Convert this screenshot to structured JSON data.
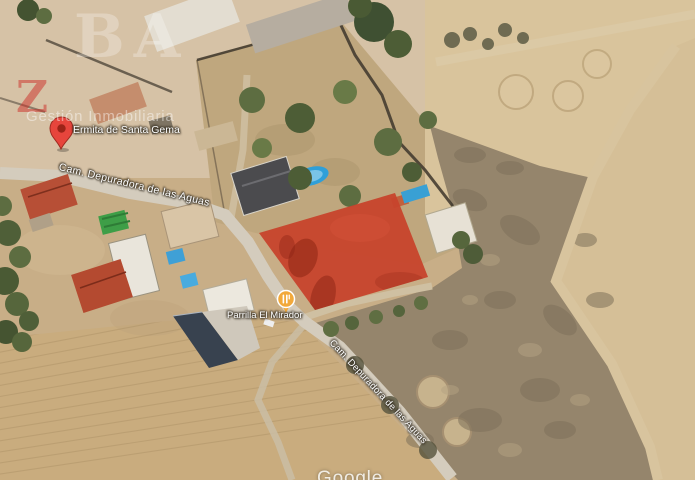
{
  "map": {
    "attribution": "Google",
    "marker": {
      "label": "Ermita de Santa Gema",
      "icon": "red-map-pin"
    },
    "poi": {
      "label": "Parrilla El Mirador",
      "icon": "restaurant-icon"
    },
    "road_labels": [
      {
        "id": "upper",
        "text": "Cam. Depuradora de las Aguas"
      },
      {
        "id": "lower",
        "text": "Cam. Depuradora de las Aguas"
      }
    ],
    "highlighted_parcel": {
      "shape": "quadrilateral",
      "color": "#c7432c"
    }
  },
  "watermark": {
    "letters": "BA",
    "accent_letter": "Z",
    "tagline": "Gestión Inmobiliaria"
  },
  "colors": {
    "parcel_red": "#c7432c",
    "pin_red": "#e7453c",
    "poi_yellow": "#f2a93b",
    "pool_blue": "#3fa0d6",
    "road_gray": "#d4ccbd",
    "field_tan": "#c9ac7e",
    "scrub_brown": "#95856c"
  }
}
